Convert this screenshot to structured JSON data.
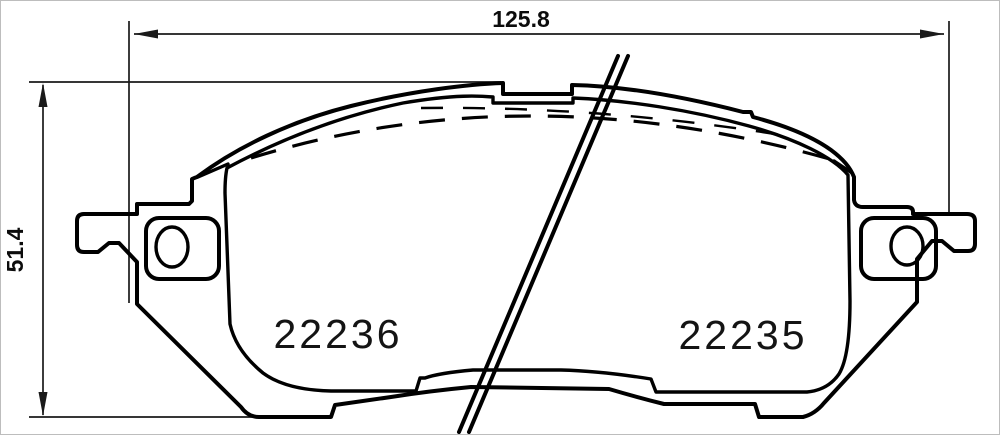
{
  "drawing": {
    "type": "brake-pad-technical-drawing",
    "dimensions": {
      "width_label": "125.8",
      "height_label": "51.4"
    },
    "part_numbers": {
      "left": "22236",
      "right": "22235"
    },
    "colors": {
      "line": "#000000",
      "dimension_line": "#1a1a1a",
      "background": "#ffffff",
      "frame_border": "#bdbdbd"
    }
  }
}
